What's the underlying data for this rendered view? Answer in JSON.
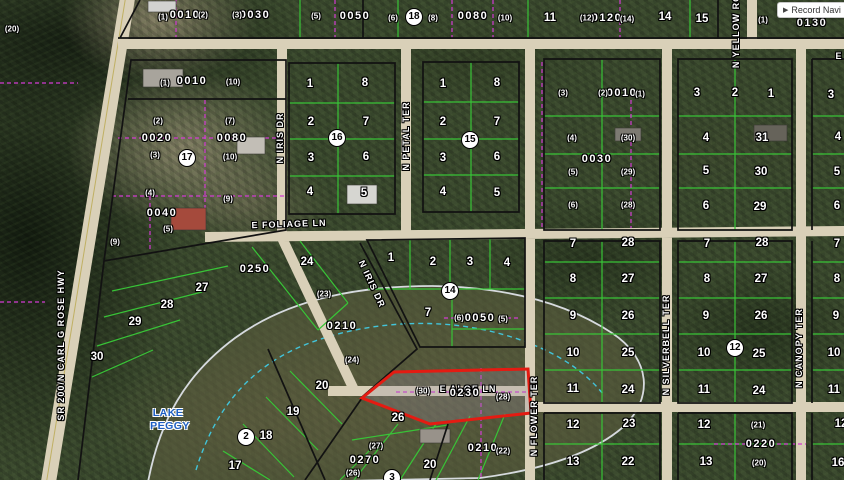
{
  "app": {
    "record_nav_icon": "▶",
    "record_nav_label": "Record Navi"
  },
  "colors": {
    "highlight_red": "#e41b12",
    "lot_line_green": "#38c437",
    "boundary_magenta": "#d23bd2",
    "road_tan": "#d9d0b8",
    "block_black": "#121212",
    "lake_label_blue": "#1d5fc4",
    "lake_outline": "#d6dade",
    "wetland_cyan": "#42c4da"
  },
  "map": {
    "lake": {
      "name_line1": "LAKE",
      "name_line2": "PEGGY",
      "x": 168,
      "y": 413,
      "y2": 426
    },
    "highlighted_parcel": {
      "id": "0230",
      "left_marker": "(30)",
      "right_marker": "(28)"
    },
    "streets": [
      {
        "label": "SR 200/N CARL G ROSE HWY",
        "x": 61,
        "y": 345,
        "rot": -90
      },
      {
        "label": "N IRIS DR",
        "x": 280,
        "y": 138,
        "rot": -90
      },
      {
        "label": "N IRIS DR",
        "x": 372,
        "y": 284,
        "rot": 65
      },
      {
        "label": "N PETAL TER",
        "x": 406,
        "y": 136,
        "rot": -90
      },
      {
        "label": "E FOLIAGE LN",
        "x": 289,
        "y": 224,
        "rot": -2
      },
      {
        "label": "E ALOE LN",
        "x": 468,
        "y": 389,
        "rot": 0
      },
      {
        "label": "N FLOWER TER",
        "x": 534,
        "y": 416,
        "rot": -90
      },
      {
        "label": "N SILVERBELL TER",
        "x": 666,
        "y": 345,
        "rot": -90
      },
      {
        "label": "N CANOPY TER",
        "x": 799,
        "y": 348,
        "rot": -90
      },
      {
        "label": "N YELLOW ROSE",
        "x": 736,
        "y": 24,
        "rot": -90
      },
      {
        "label": "E",
        "x": 839,
        "y": 56,
        "rot": 0
      }
    ],
    "section_markers": [
      {
        "n": "18",
        "x": 414,
        "y": 17
      },
      {
        "n": "17",
        "x": 187,
        "y": 158
      },
      {
        "n": "16",
        "x": 337,
        "y": 138
      },
      {
        "n": "15",
        "x": 470,
        "y": 140
      },
      {
        "n": "14",
        "x": 450,
        "y": 291
      },
      {
        "n": "12",
        "x": 735,
        "y": 348
      },
      {
        "n": "2",
        "x": 246,
        "y": 437
      },
      {
        "n": "3",
        "x": 392,
        "y": 478
      }
    ],
    "parcel_ids": [
      {
        "t": "0010",
        "x": 185,
        "y": 15
      },
      {
        "t": "0030",
        "x": 255,
        "y": 15
      },
      {
        "t": "0050",
        "x": 355,
        "y": 16
      },
      {
        "t": "0080",
        "x": 473,
        "y": 16
      },
      {
        "t": "0120",
        "x": 607,
        "y": 18
      },
      {
        "t": "0130",
        "x": 812,
        "y": 23
      },
      {
        "t": "0010",
        "x": 192,
        "y": 81
      },
      {
        "t": "0020",
        "x": 157,
        "y": 138
      },
      {
        "t": "0080",
        "x": 232,
        "y": 138
      },
      {
        "t": "0040",
        "x": 162,
        "y": 213
      },
      {
        "t": "0250",
        "x": 255,
        "y": 269
      },
      {
        "t": "0210",
        "x": 342,
        "y": 326
      },
      {
        "t": "0050",
        "x": 480,
        "y": 318
      },
      {
        "t": "0010",
        "x": 622,
        "y": 93
      },
      {
        "t": "0030",
        "x": 597,
        "y": 159
      },
      {
        "t": "0230",
        "x": 465,
        "y": 393
      },
      {
        "t": "0210",
        "x": 483,
        "y": 448
      },
      {
        "t": "0270",
        "x": 365,
        "y": 460
      },
      {
        "t": "0220",
        "x": 761,
        "y": 444
      }
    ],
    "lot_numbers": [
      {
        "t": "11",
        "x": 550,
        "y": 18
      },
      {
        "t": "14",
        "x": 665,
        "y": 17
      },
      {
        "t": "15",
        "x": 702,
        "y": 19
      },
      {
        "t": "1",
        "x": 310,
        "y": 84
      },
      {
        "t": "8",
        "x": 365,
        "y": 83
      },
      {
        "t": "2",
        "x": 311,
        "y": 122
      },
      {
        "t": "7",
        "x": 366,
        "y": 122
      },
      {
        "t": "3",
        "x": 311,
        "y": 158
      },
      {
        "t": "6",
        "x": 366,
        "y": 157
      },
      {
        "t": "4",
        "x": 310,
        "y": 192
      },
      {
        "t": "5",
        "x": 364,
        "y": 193
      },
      {
        "t": "1",
        "x": 443,
        "y": 84
      },
      {
        "t": "8",
        "x": 497,
        "y": 83
      },
      {
        "t": "2",
        "x": 443,
        "y": 122
      },
      {
        "t": "7",
        "x": 497,
        "y": 122
      },
      {
        "t": "3",
        "x": 443,
        "y": 158
      },
      {
        "t": "6",
        "x": 497,
        "y": 157
      },
      {
        "t": "4",
        "x": 443,
        "y": 192
      },
      {
        "t": "5",
        "x": 497,
        "y": 193
      },
      {
        "t": "1",
        "x": 391,
        "y": 258
      },
      {
        "t": "2",
        "x": 433,
        "y": 262
      },
      {
        "t": "3",
        "x": 470,
        "y": 262
      },
      {
        "t": "4",
        "x": 507,
        "y": 263
      },
      {
        "t": "7",
        "x": 428,
        "y": 313
      },
      {
        "t": "3",
        "x": 697,
        "y": 93
      },
      {
        "t": "2",
        "x": 735,
        "y": 93
      },
      {
        "t": "1",
        "x": 771,
        "y": 94
      },
      {
        "t": "4",
        "x": 706,
        "y": 138
      },
      {
        "t": "31",
        "x": 762,
        "y": 138
      },
      {
        "t": "5",
        "x": 706,
        "y": 171
      },
      {
        "t": "30",
        "x": 761,
        "y": 172
      },
      {
        "t": "6",
        "x": 706,
        "y": 206
      },
      {
        "t": "29",
        "x": 760,
        "y": 207
      },
      {
        "t": "7",
        "x": 573,
        "y": 244
      },
      {
        "t": "28",
        "x": 628,
        "y": 243
      },
      {
        "t": "8",
        "x": 573,
        "y": 279
      },
      {
        "t": "27",
        "x": 628,
        "y": 279
      },
      {
        "t": "9",
        "x": 573,
        "y": 316
      },
      {
        "t": "26",
        "x": 628,
        "y": 316
      },
      {
        "t": "10",
        "x": 573,
        "y": 353
      },
      {
        "t": "25",
        "x": 628,
        "y": 353
      },
      {
        "t": "11",
        "x": 573,
        "y": 389
      },
      {
        "t": "24",
        "x": 628,
        "y": 390
      },
      {
        "t": "7",
        "x": 707,
        "y": 244
      },
      {
        "t": "28",
        "x": 762,
        "y": 243
      },
      {
        "t": "8",
        "x": 707,
        "y": 279
      },
      {
        "t": "27",
        "x": 761,
        "y": 279
      },
      {
        "t": "9",
        "x": 706,
        "y": 316
      },
      {
        "t": "26",
        "x": 761,
        "y": 316
      },
      {
        "t": "10",
        "x": 704,
        "y": 353
      },
      {
        "t": "25",
        "x": 759,
        "y": 354
      },
      {
        "t": "11",
        "x": 704,
        "y": 390
      },
      {
        "t": "24",
        "x": 759,
        "y": 391
      },
      {
        "t": "3",
        "x": 831,
        "y": 95
      },
      {
        "t": "4",
        "x": 838,
        "y": 137
      },
      {
        "t": "5",
        "x": 837,
        "y": 172
      },
      {
        "t": "6",
        "x": 837,
        "y": 206
      },
      {
        "t": "7",
        "x": 837,
        "y": 244
      },
      {
        "t": "8",
        "x": 837,
        "y": 279
      },
      {
        "t": "9",
        "x": 836,
        "y": 316
      },
      {
        "t": "10",
        "x": 834,
        "y": 353
      },
      {
        "t": "11",
        "x": 834,
        "y": 390
      },
      {
        "t": "12",
        "x": 573,
        "y": 425
      },
      {
        "t": "23",
        "x": 629,
        "y": 424
      },
      {
        "t": "13",
        "x": 573,
        "y": 462
      },
      {
        "t": "22",
        "x": 628,
        "y": 462
      },
      {
        "t": "12",
        "x": 704,
        "y": 425
      },
      {
        "t": "13",
        "x": 706,
        "y": 462
      },
      {
        "t": "12",
        "x": 841,
        "y": 424
      },
      {
        "t": "16",
        "x": 838,
        "y": 463
      },
      {
        "t": "27",
        "x": 202,
        "y": 288
      },
      {
        "t": "28",
        "x": 167,
        "y": 305
      },
      {
        "t": "29",
        "x": 135,
        "y": 322
      },
      {
        "t": "30",
        "x": 97,
        "y": 357
      },
      {
        "t": "24",
        "x": 307,
        "y": 262
      },
      {
        "t": "20",
        "x": 322,
        "y": 386
      },
      {
        "t": "19",
        "x": 293,
        "y": 412
      },
      {
        "t": "18",
        "x": 266,
        "y": 436
      },
      {
        "t": "17",
        "x": 235,
        "y": 466
      },
      {
        "t": "26",
        "x": 398,
        "y": 418
      },
      {
        "t": "20",
        "x": 430,
        "y": 465
      }
    ],
    "small_markers": [
      {
        "t": "(20)",
        "x": 12,
        "y": 29
      },
      {
        "t": "(1)",
        "x": 163,
        "y": 17
      },
      {
        "t": "(2)",
        "x": 203,
        "y": 15
      },
      {
        "t": "(3)",
        "x": 237,
        "y": 15
      },
      {
        "t": "(1)",
        "x": 165,
        "y": 83
      },
      {
        "t": "(10)",
        "x": 233,
        "y": 82
      },
      {
        "t": "(5)",
        "x": 316,
        "y": 16
      },
      {
        "t": "(6)",
        "x": 393,
        "y": 18
      },
      {
        "t": "(8)",
        "x": 433,
        "y": 18
      },
      {
        "t": "(10)",
        "x": 505,
        "y": 18
      },
      {
        "t": "(12)",
        "x": 587,
        "y": 18
      },
      {
        "t": "(14)",
        "x": 627,
        "y": 19
      },
      {
        "t": "(1)",
        "x": 763,
        "y": 20
      },
      {
        "t": "(2)",
        "x": 158,
        "y": 121
      },
      {
        "t": "(3)",
        "x": 155,
        "y": 155
      },
      {
        "t": "(7)",
        "x": 230,
        "y": 121
      },
      {
        "t": "(10)",
        "x": 230,
        "y": 157
      },
      {
        "t": "(4)",
        "x": 150,
        "y": 193
      },
      {
        "t": "(9)",
        "x": 228,
        "y": 199
      },
      {
        "t": "(5)",
        "x": 168,
        "y": 229
      },
      {
        "t": "(9)",
        "x": 115,
        "y": 242
      },
      {
        "t": "(23)",
        "x": 324,
        "y": 294
      },
      {
        "t": "(24)",
        "x": 352,
        "y": 360
      },
      {
        "t": "(6)",
        "x": 459,
        "y": 318
      },
      {
        "t": "(5)",
        "x": 503,
        "y": 319
      },
      {
        "t": "(30)",
        "x": 423,
        "y": 391
      },
      {
        "t": "(28)",
        "x": 503,
        "y": 397
      },
      {
        "t": "(27)",
        "x": 376,
        "y": 446
      },
      {
        "t": "(26)",
        "x": 353,
        "y": 473
      },
      {
        "t": "(22)",
        "x": 503,
        "y": 451
      },
      {
        "t": "(3)",
        "x": 563,
        "y": 93
      },
      {
        "t": "(2)",
        "x": 603,
        "y": 93
      },
      {
        "t": "(1)",
        "x": 640,
        "y": 94
      },
      {
        "t": "(4)",
        "x": 572,
        "y": 138
      },
      {
        "t": "(30)",
        "x": 628,
        "y": 138
      },
      {
        "t": "(5)",
        "x": 573,
        "y": 172
      },
      {
        "t": "(29)",
        "x": 628,
        "y": 172
      },
      {
        "t": "(6)",
        "x": 573,
        "y": 205
      },
      {
        "t": "(28)",
        "x": 628,
        "y": 205
      },
      {
        "t": "(21)",
        "x": 758,
        "y": 425
      },
      {
        "t": "(20)",
        "x": 759,
        "y": 463
      }
    ]
  }
}
